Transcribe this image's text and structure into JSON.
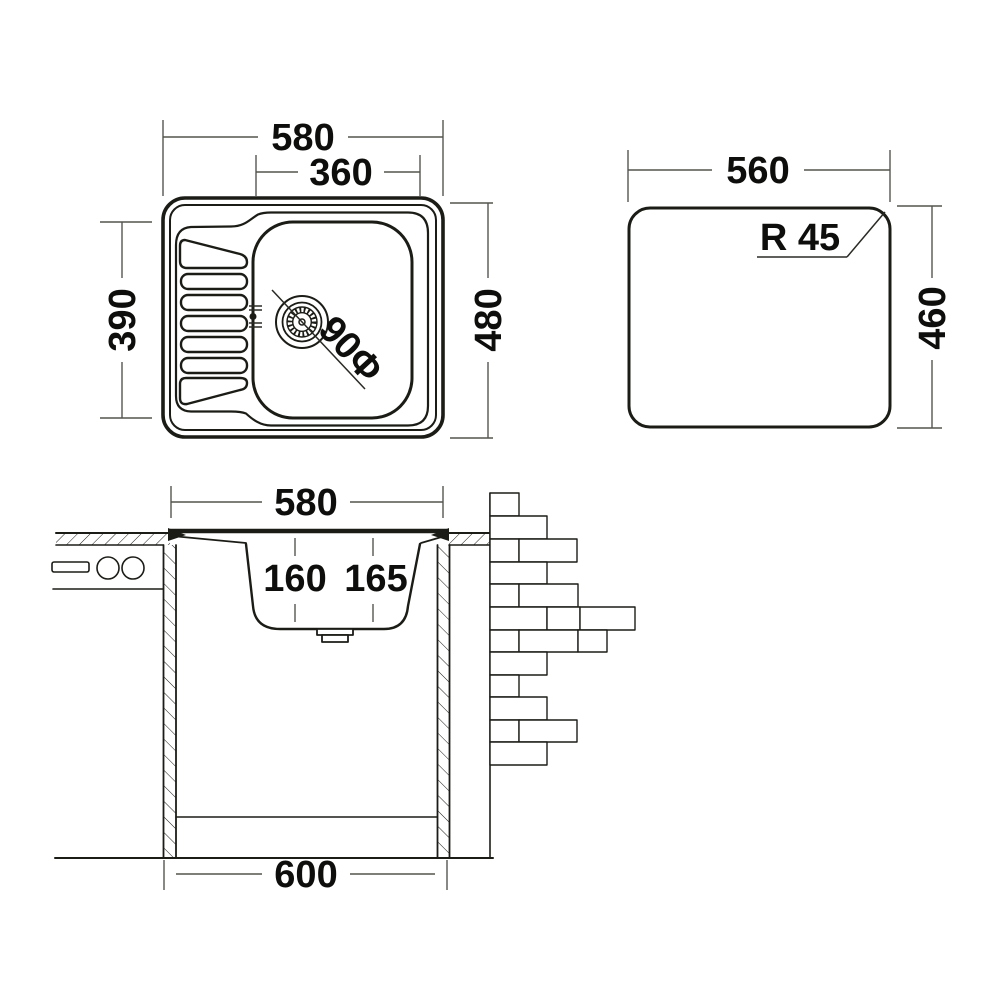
{
  "title": "kitchen-sink-technical-drawing",
  "colors": {
    "ink": "#1c1c17",
    "dimension_line": "#55554f",
    "text": "#0e0e0c",
    "background": "#ffffff"
  },
  "views": {
    "plan": {
      "label": "sink-top-view",
      "overall_width": "580",
      "bowl_width": "360",
      "drainboard_depth": "390",
      "overall_depth": "480",
      "drain_diameter": "90Φ"
    },
    "cutout": {
      "label": "worktop-cutout-template",
      "width": "560",
      "height": "460",
      "corner_radius": "R 45"
    },
    "section": {
      "label": "installation-section-view",
      "rim_width": "580",
      "bowl_depth_front": "160",
      "bowl_depth_rear": "165",
      "cabinet_width": "600"
    }
  }
}
